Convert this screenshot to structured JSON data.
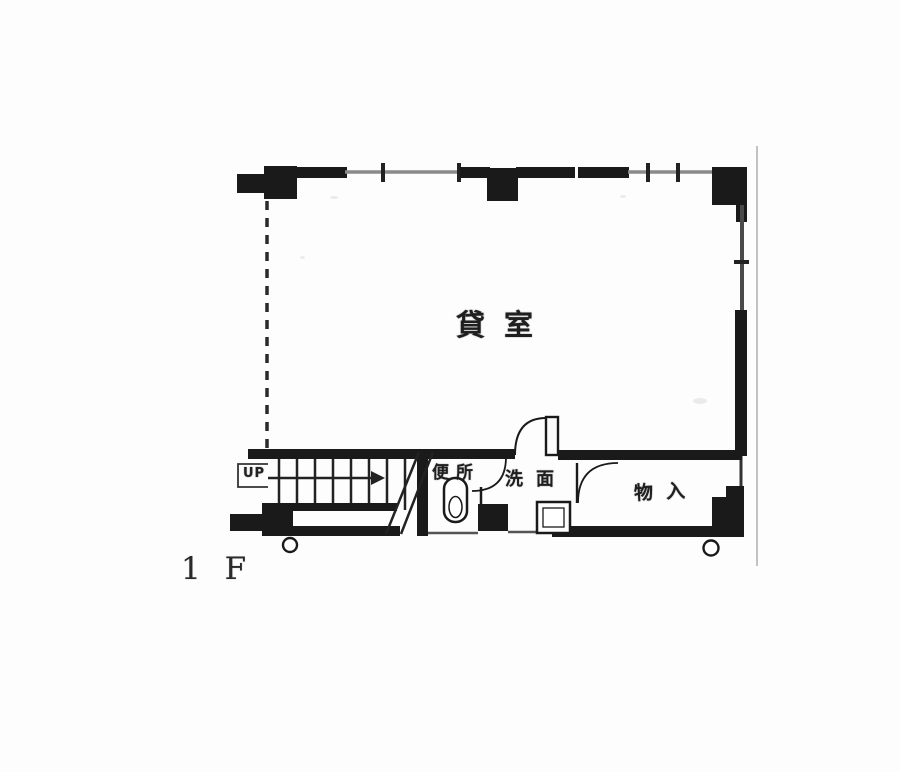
{
  "floor_plan": {
    "floor_label": "1 F",
    "rooms": [
      {
        "name": "main-room",
        "label": "貸室"
      },
      {
        "name": "toilet",
        "label": "便所"
      },
      {
        "name": "washroom",
        "label": "洗面"
      },
      {
        "name": "storage",
        "label": "物入"
      }
    ],
    "stairs": {
      "up_label": "UP"
    },
    "colors": {
      "ink": "#1a1a1a",
      "window_line": "#8a8a8a",
      "paper": "#fdfdfd",
      "scan_artifact": "#c2c2c2"
    }
  }
}
